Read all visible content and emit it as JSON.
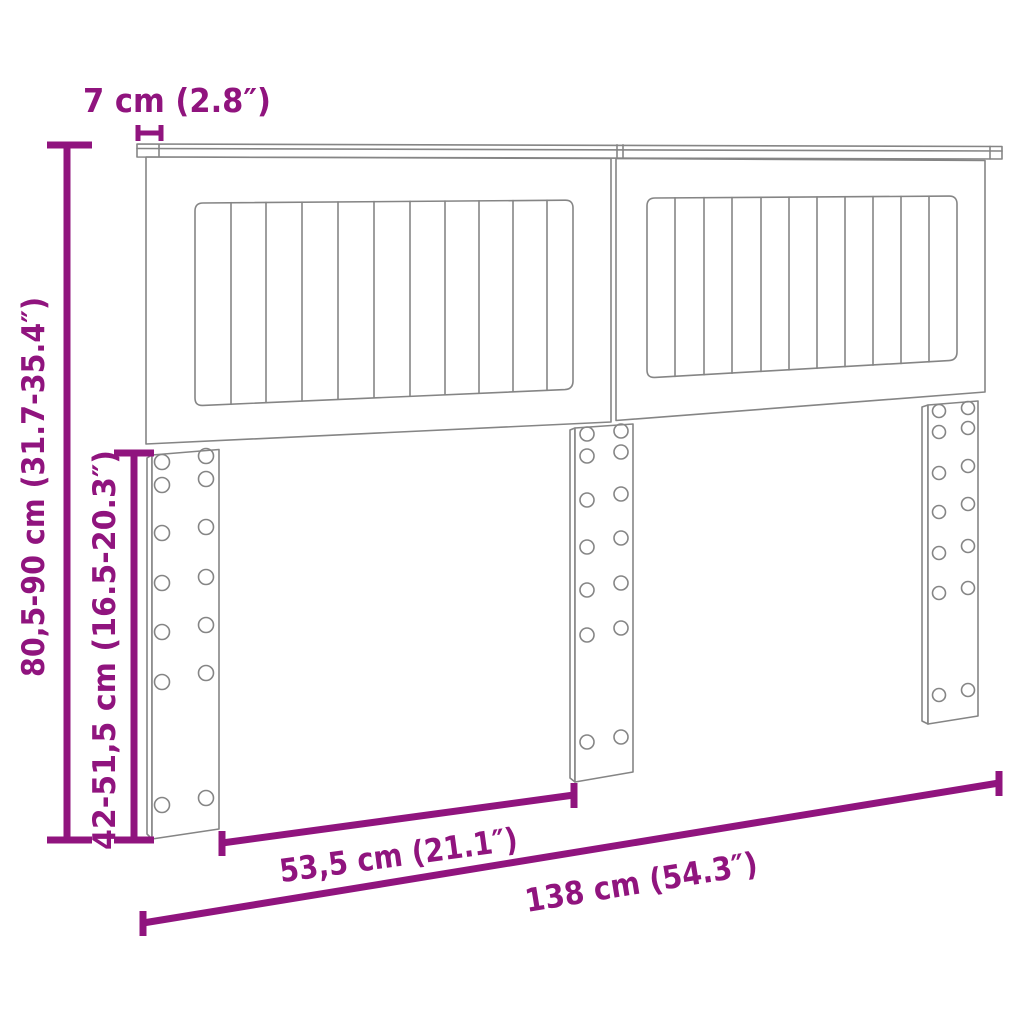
{
  "dimensions": {
    "thickness_label": "7 cm (2.8″)",
    "height_label": "80,5-90 cm (31.7-35.4″)",
    "leg_height_label": "42-51,5 cm (16.5-20.3″)",
    "leg_spacing_label": "53,5 cm (21.1″)",
    "width_label": "138 cm (54.3″)"
  },
  "colors": {
    "accent": "#90147E",
    "line_art": "#858585",
    "background": "#FFFFFF"
  }
}
